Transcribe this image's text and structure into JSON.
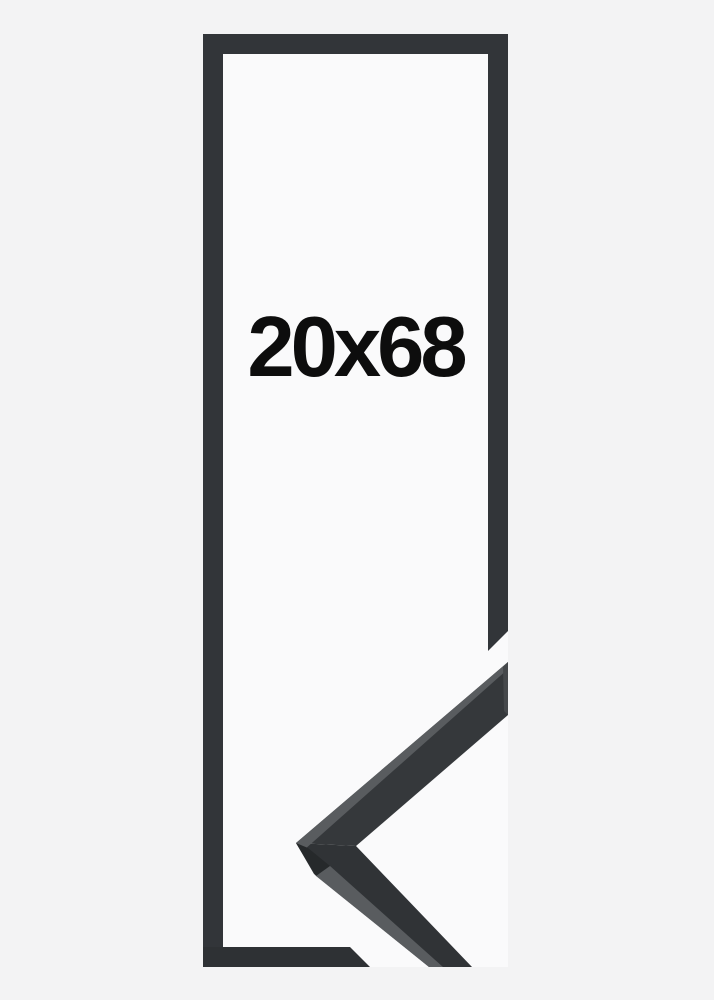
{
  "frame_preview": {
    "size_label": "20x68"
  },
  "colors": {
    "background": "#f3f3f4",
    "frame-interior": "#fafafb",
    "frame-outline": "#323539",
    "frame-outline-dark": "#2e3134",
    "corner-face": "#35383b",
    "corner-face-dark": "#303336",
    "bevel-light": "#595c5f",
    "bevel-dark": "#26292b",
    "miter-sliver": "#45484b",
    "label-text": "#0d0d0d"
  }
}
